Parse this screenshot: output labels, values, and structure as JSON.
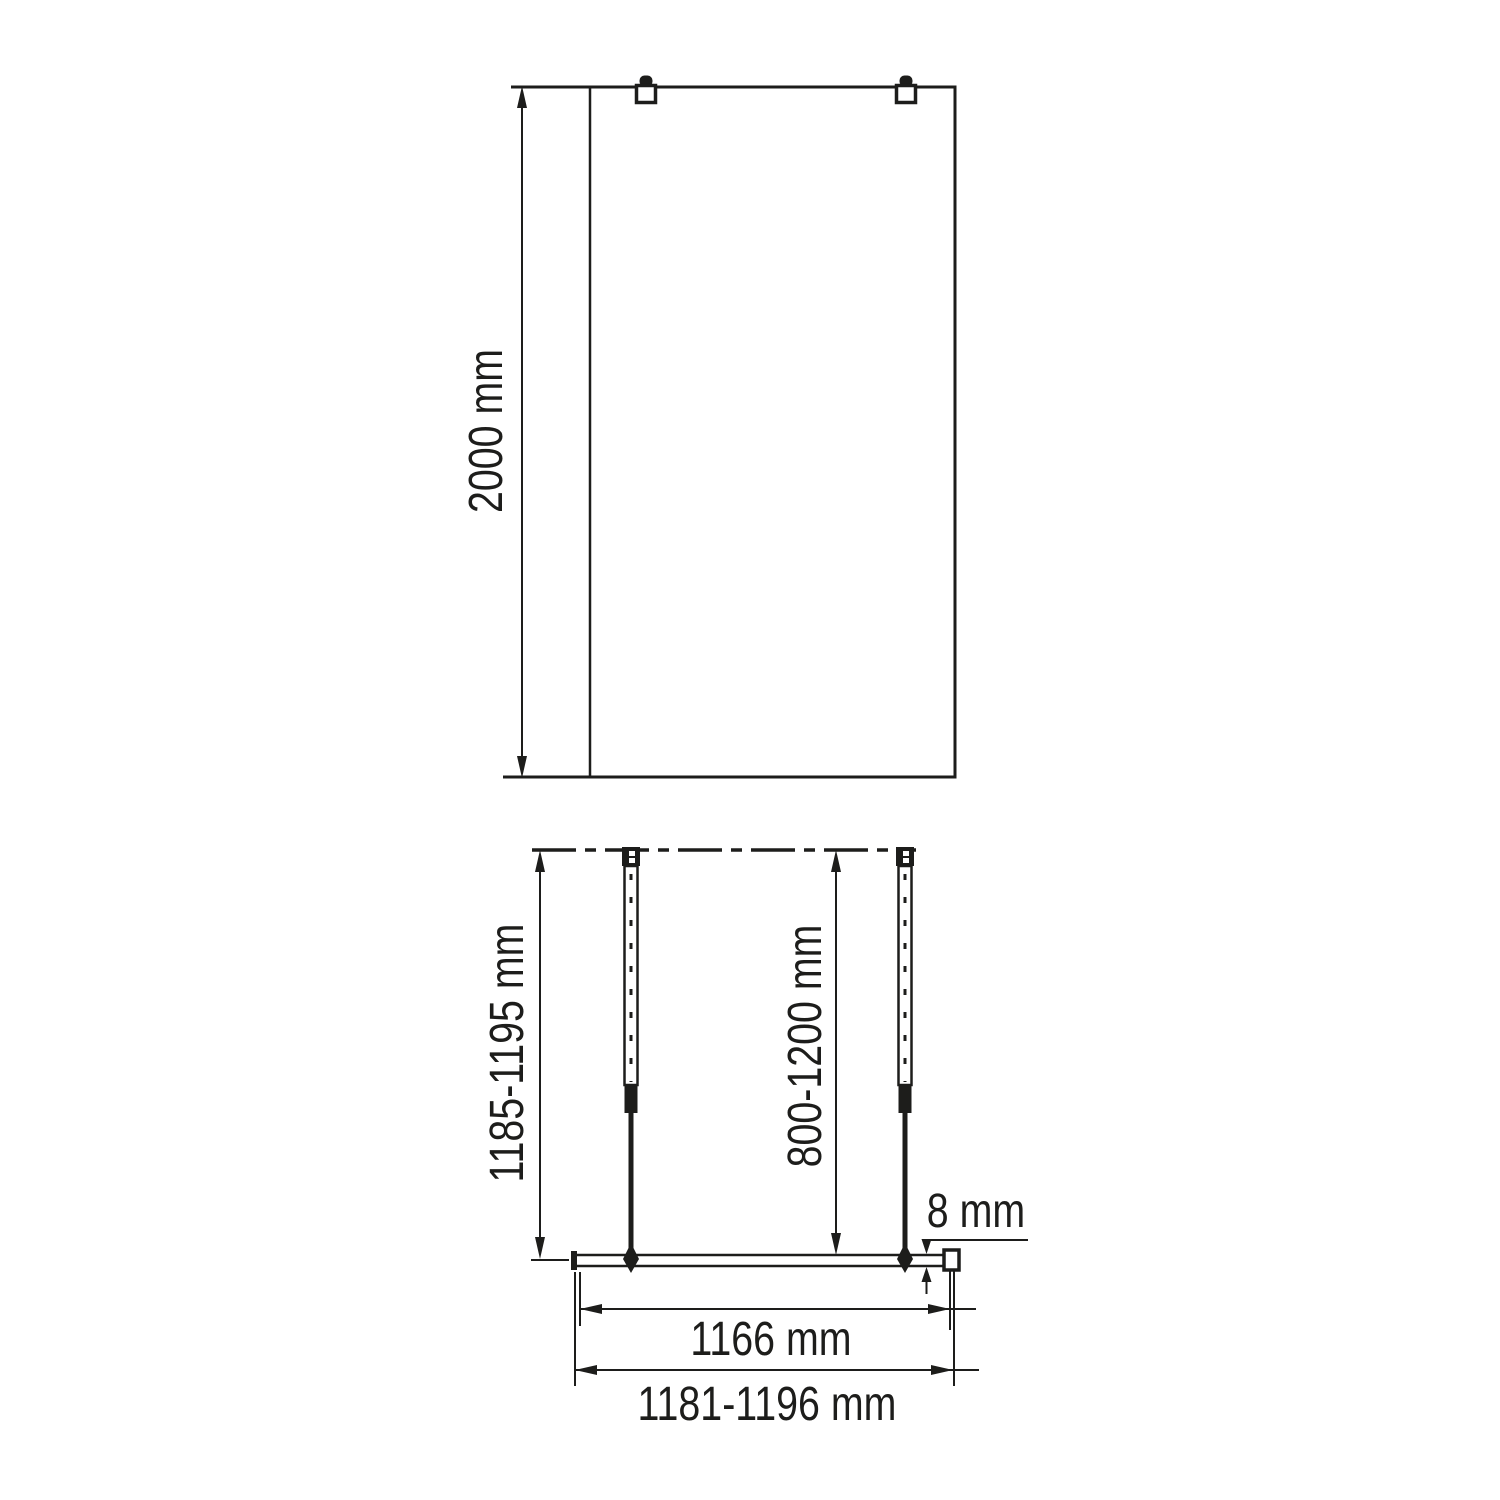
{
  "front_view": {
    "height": "2000 mm"
  },
  "plan_view": {
    "installation_depth": "1185-1195 mm",
    "support_bar_length": "800-1200 mm",
    "glass_thickness": "8 mm",
    "glass_width": "1166 mm",
    "overall_width": "1181-1196 mm"
  },
  "colors": {
    "line": "#1d1d1b",
    "background": "#ffffff"
  }
}
